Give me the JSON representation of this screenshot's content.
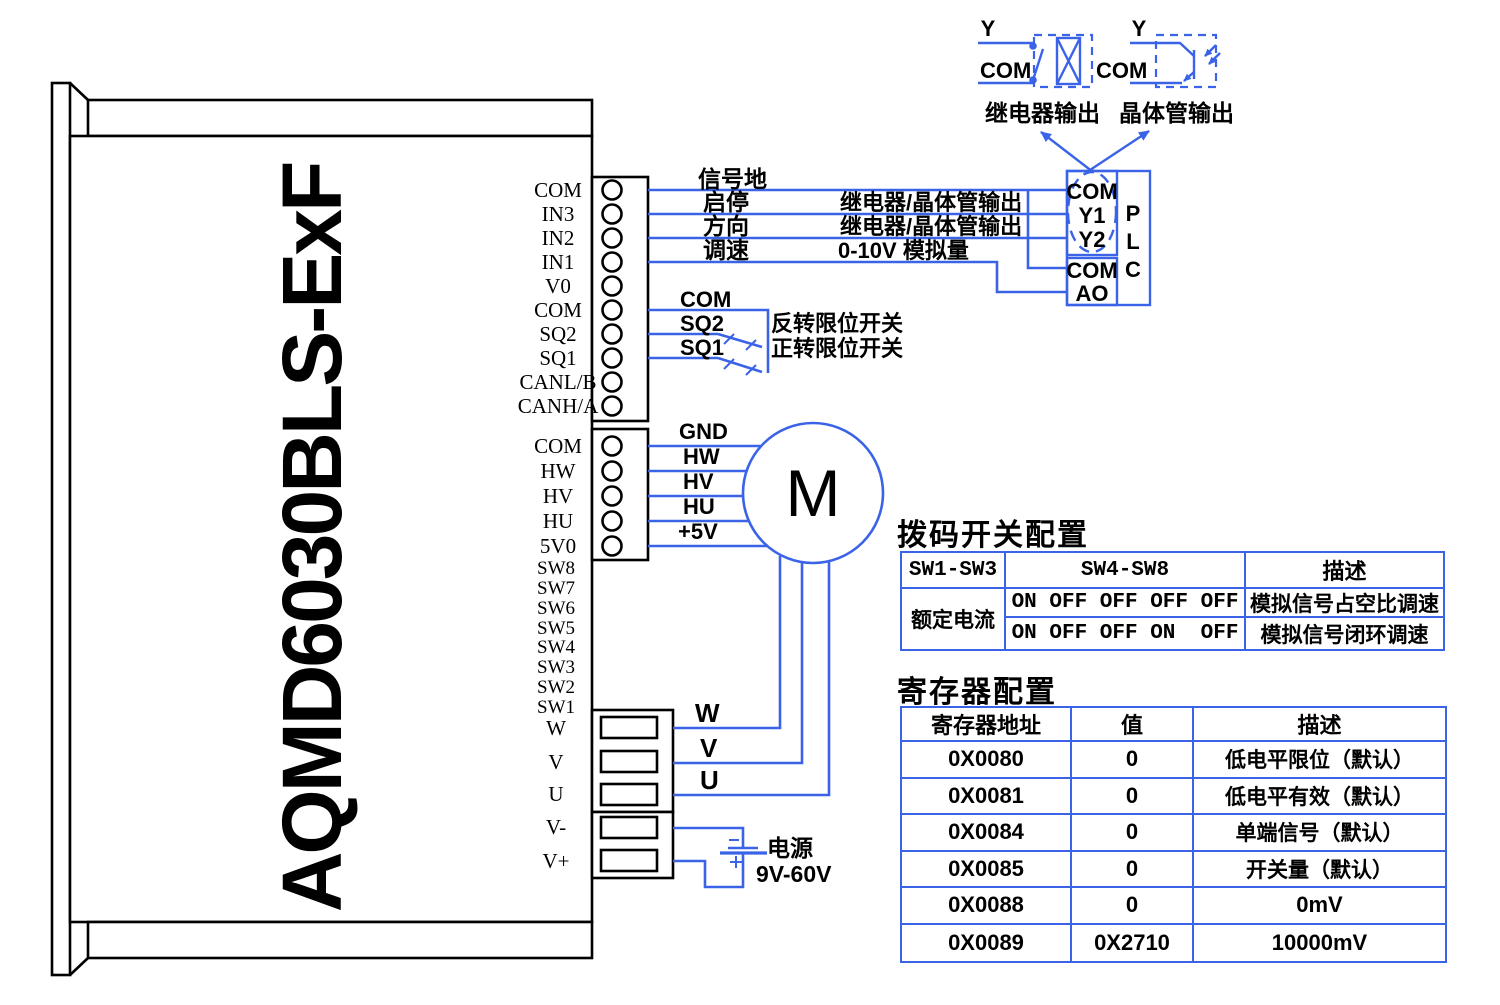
{
  "device": {
    "model": "AQMD6030BLS-ExF"
  },
  "blocks": {
    "signal": [
      "COM",
      "IN3",
      "IN2",
      "IN1",
      "V0",
      "COM",
      "SQ2",
      "SQ1",
      "CANL/B",
      "CANH/A"
    ],
    "hall": [
      "COM",
      "HW",
      "HV",
      "HU",
      "5V0"
    ],
    "dip": [
      "SW8",
      "SW7",
      "SW6",
      "SW5",
      "SW4",
      "SW3",
      "SW2",
      "SW1"
    ],
    "phase": [
      "W",
      "V",
      "U"
    ],
    "supply": [
      "V-",
      "V+"
    ]
  },
  "wire_labels": {
    "signal_ground": "信号地",
    "start_stop": "启停",
    "direction": "方向",
    "speed": "调速",
    "relay_transistor_1": "继电器/晶体管输出",
    "relay_transistor_2": "继电器/晶体管输出",
    "analog": "0-10V 模拟量",
    "com": "COM",
    "sq2": "SQ2",
    "sq1": "SQ1",
    "reverse_limit": "反转限位开关",
    "forward_limit": "正转限位开关",
    "gnd": "GND",
    "hw": "HW",
    "hv": "HV",
    "hu": "HU",
    "p5v": "+5V",
    "w": "W",
    "v": "V",
    "u": "U",
    "power": "电源",
    "power_range": "9V-60V"
  },
  "motor": {
    "label": "M"
  },
  "plc": {
    "top": [
      "COM",
      "Y1",
      "Y2"
    ],
    "bottom": [
      "COM",
      "AO"
    ],
    "name": [
      "P",
      "L",
      "C"
    ]
  },
  "outputs": {
    "relay": {
      "y": "Y",
      "com": "COM",
      "caption": "继电器输出"
    },
    "transistor": {
      "y": "Y",
      "com": "COM",
      "caption": "晶体管输出"
    }
  },
  "dip_table": {
    "title": "拨码开关配置",
    "headers": [
      "SW1-SW3",
      "SW4-SW8",
      "描述"
    ],
    "group": "额定电流",
    "rows": [
      {
        "sw": "ON OFF OFF OFF OFF",
        "desc": "模拟信号占空比调速"
      },
      {
        "sw": "ON OFF OFF ON  OFF",
        "desc": "模拟信号闭环调速"
      }
    ]
  },
  "register_table": {
    "title": "寄存器配置",
    "headers": [
      "寄存器地址",
      "值",
      "描述"
    ],
    "rows": [
      {
        "addr": "0X0080",
        "value": "0",
        "desc": "低电平限位（默认）"
      },
      {
        "addr": "0X0081",
        "value": "0",
        "desc": "低电平有效（默认）"
      },
      {
        "addr": "0X0084",
        "value": "0",
        "desc": "单端信号（默认）"
      },
      {
        "addr": "0X0085",
        "value": "0",
        "desc": "开关量（默认）"
      },
      {
        "addr": "0X0088",
        "value": "0",
        "desc": "0mV"
      },
      {
        "addr": "0X0089",
        "value": "0X2710",
        "desc": "10000mV"
      }
    ]
  }
}
